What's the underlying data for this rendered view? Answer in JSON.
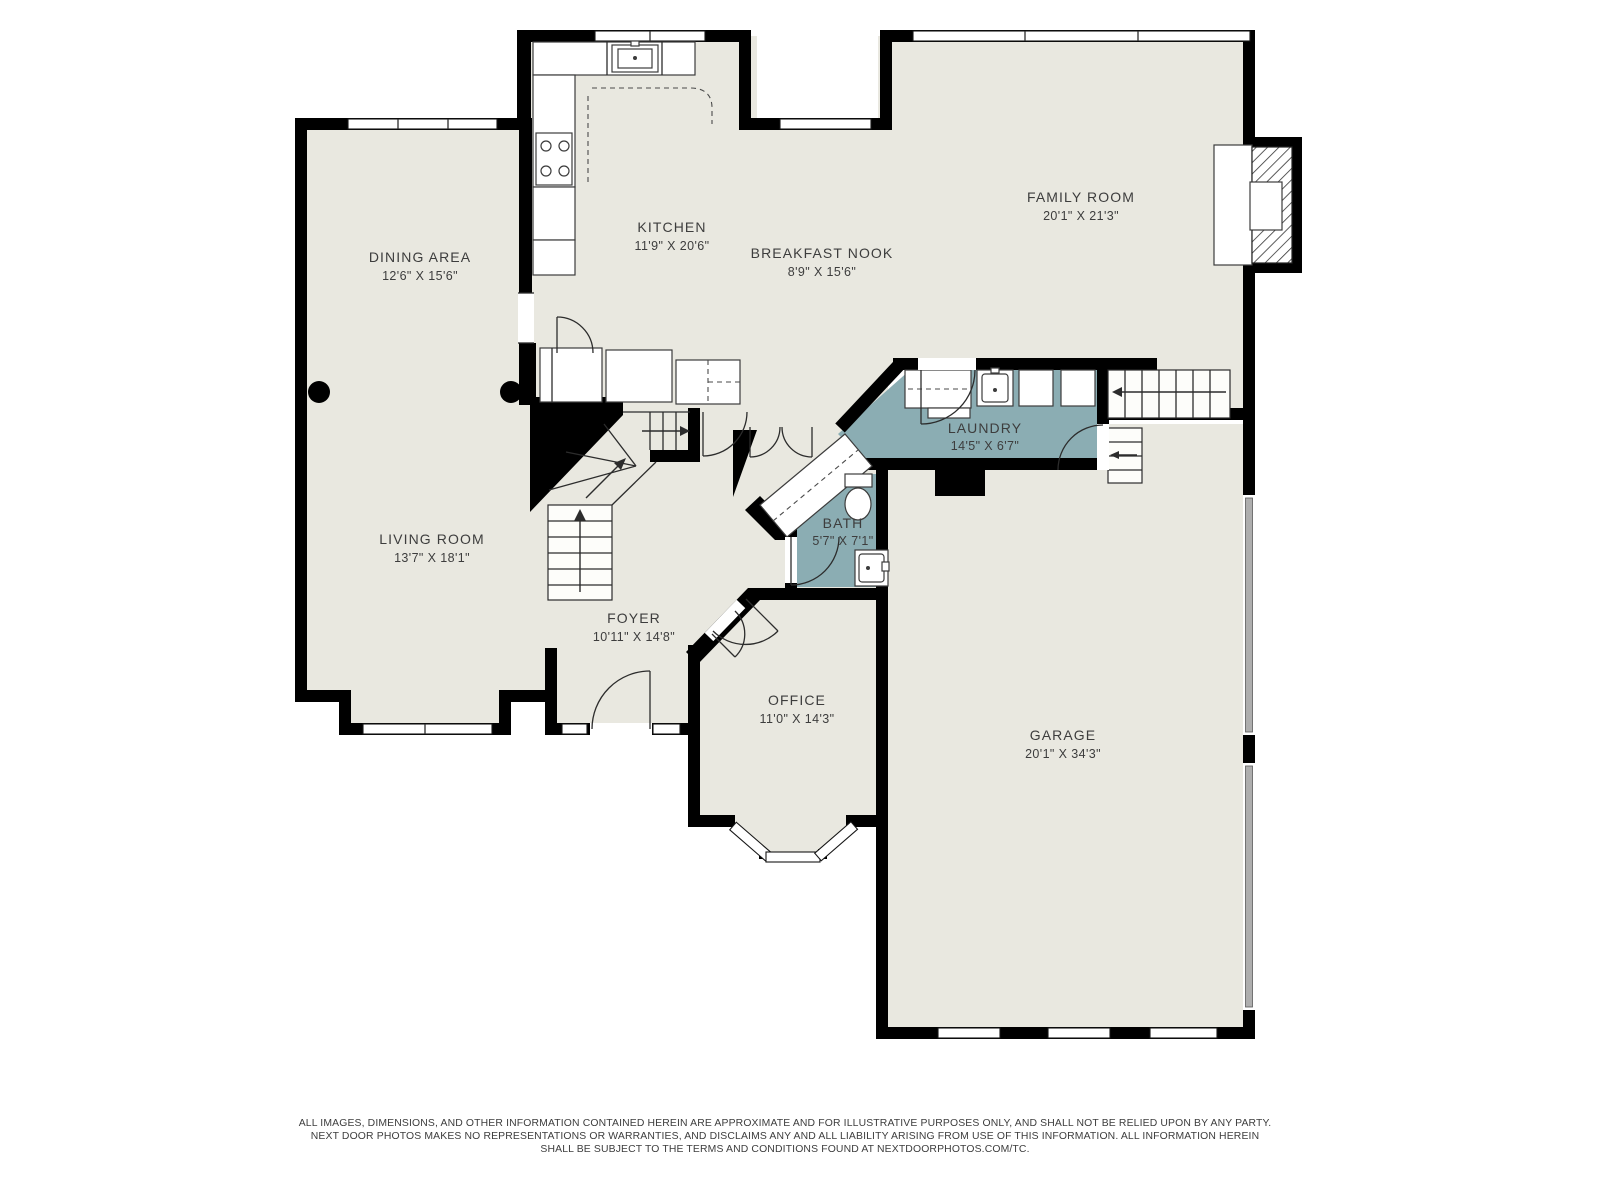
{
  "palette": {
    "background": "#ffffff",
    "floor": "#e9e8e0",
    "wet_room": "#8badb3",
    "wall": "#000000",
    "label_text": "#3d3d3d",
    "garage_door": "#aeaeae"
  },
  "rooms": [
    {
      "id": "dining",
      "name": "DINING AREA",
      "dims": "12'6\" X 15'6\""
    },
    {
      "id": "kitchen",
      "name": "KITCHEN",
      "dims": "11'9\" X 20'6\""
    },
    {
      "id": "breakfast",
      "name": "BREAKFAST NOOK",
      "dims": "8'9\" X 15'6\""
    },
    {
      "id": "family",
      "name": "FAMILY ROOM",
      "dims": "20'1\" X 21'3\""
    },
    {
      "id": "laundry",
      "name": "LAUNDRY",
      "dims": "14'5\" X 6'7\""
    },
    {
      "id": "bath",
      "name": "BATH",
      "dims": "5'7\" X 7'1\""
    },
    {
      "id": "living",
      "name": "LIVING ROOM",
      "dims": "13'7\" X 18'1\""
    },
    {
      "id": "foyer",
      "name": "FOYER",
      "dims": "10'11\" X 14'8\""
    },
    {
      "id": "office",
      "name": "OFFICE",
      "dims": "11'0\" X 14'3\""
    },
    {
      "id": "garage",
      "name": "GARAGE",
      "dims": "20'1\" X 34'3\""
    }
  ],
  "disclaimer": {
    "line1": "ALL IMAGES, DIMENSIONS, AND OTHER INFORMATION CONTAINED HEREIN ARE APPROXIMATE AND FOR ILLUSTRATIVE PURPOSES ONLY, AND SHALL NOT BE RELIED UPON BY ANY PARTY.",
    "line2": "NEXT DOOR PHOTOS MAKES NO REPRESENTATIONS OR WARRANTIES, AND DISCLAIMS ANY AND ALL LIABILITY ARISING FROM USE OF THIS INFORMATION. ALL INFORMATION HEREIN",
    "line3": "SHALL BE SUBJECT TO THE TERMS AND CONDITIONS FOUND AT NEXTDOORPHOTOS.COM/TC."
  }
}
